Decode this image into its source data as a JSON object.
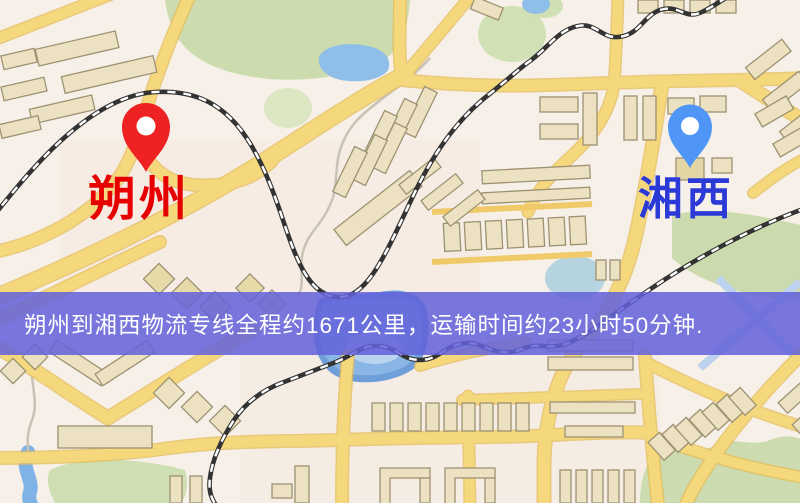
{
  "page": {
    "width": 800,
    "height": 503,
    "kind": "logistics-route-map-image"
  },
  "map": {
    "type": "static-road-map",
    "origin": {
      "city": "朔州",
      "pin_color": "#ee2222",
      "pin_hole_color": "#ffffff",
      "label_color": "#e60000"
    },
    "destination": {
      "city": "湘西",
      "pin_color": "#4f96f6",
      "pin_hole_color": "#ffffff",
      "label_color": "#2b3ad6"
    },
    "banner": {
      "text": "朔州到湘西物流专线全程约1671公里，运输时间约23小时50分钟.",
      "origin": "朔州",
      "destination": "湘西",
      "service": "物流专线",
      "distance_km": "1671",
      "duration": "23小时50分钟",
      "background_color": "#6362da",
      "text_color": "#ffffff"
    },
    "palette": {
      "land": "#f6f0e8",
      "road": "#f6d87c",
      "road_casing": "#e5bd58",
      "railway": "#333333",
      "railway_dash": "#ffffff",
      "water": "#8fbfe9",
      "park": "#cddcae",
      "building_fill": "#ece2c2",
      "building_stroke": "#9d9272"
    }
  }
}
